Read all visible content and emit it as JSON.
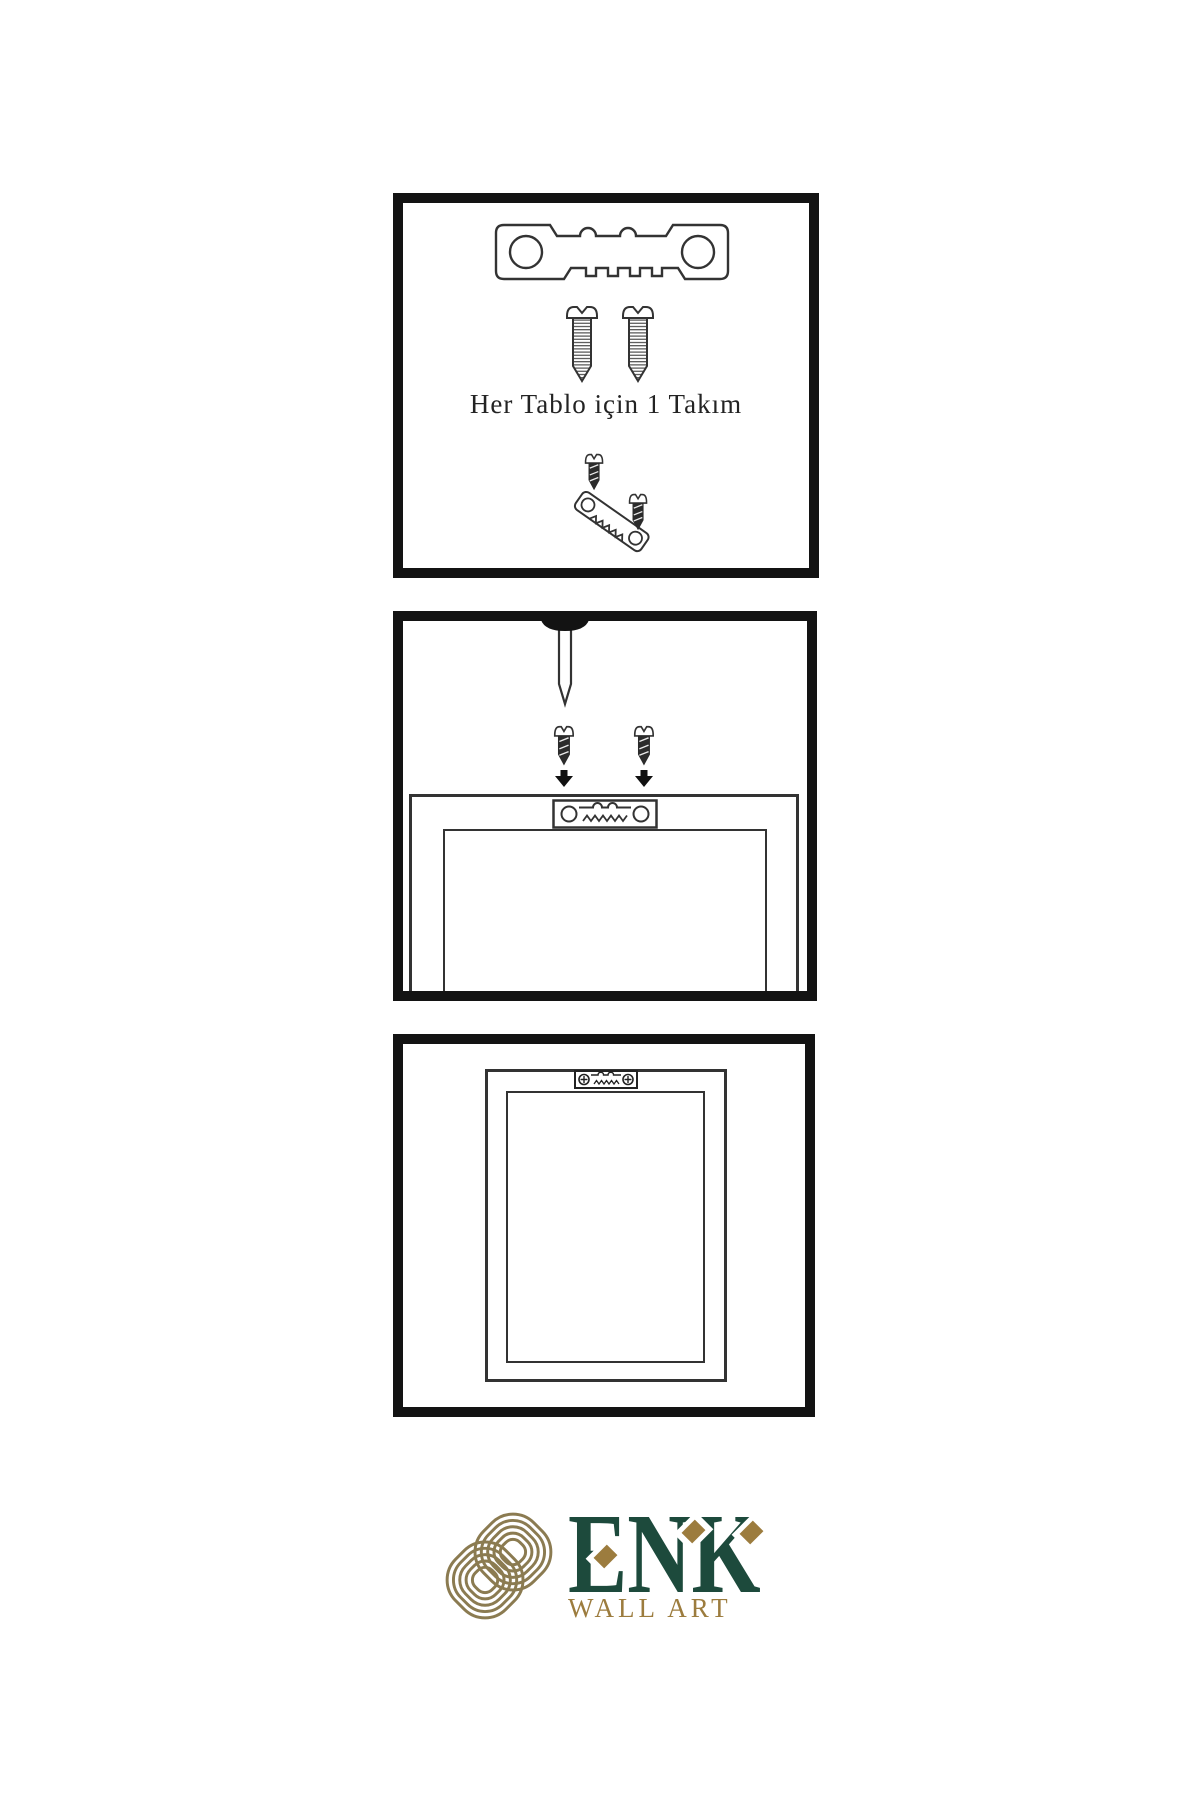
{
  "page": {
    "background": "#ffffff"
  },
  "colors": {
    "panel_border": "#131313",
    "line_art": "#333333",
    "dark_fill": "#2b2b2b",
    "logo_green": "#1d4a3c",
    "logo_gold": "#9c7c3e",
    "knot_gold": "#8b7b51"
  },
  "panel1": {
    "name": "hardware-kit-panel",
    "caption": "Her Tablo için 1 Takım",
    "icons": [
      "sawtooth-hanger-icon",
      "screw-icon",
      "screw-icon",
      "hanger-assembly-icon"
    ]
  },
  "panel2": {
    "name": "attach-hanger-panel",
    "icons": [
      "nail-icon",
      "screw-icon",
      "screw-icon",
      "arrow-down-icon",
      "arrow-down-icon",
      "frame-back-icon",
      "sawtooth-hanger-plate-icon"
    ]
  },
  "panel3": {
    "name": "mounted-frame-panel",
    "icons": [
      "frame-back-icon",
      "mounted-sawtooth-hanger-icon"
    ]
  },
  "logo": {
    "mark": "knot-icon",
    "title": "ENK",
    "subtitle": "WALL ART"
  }
}
